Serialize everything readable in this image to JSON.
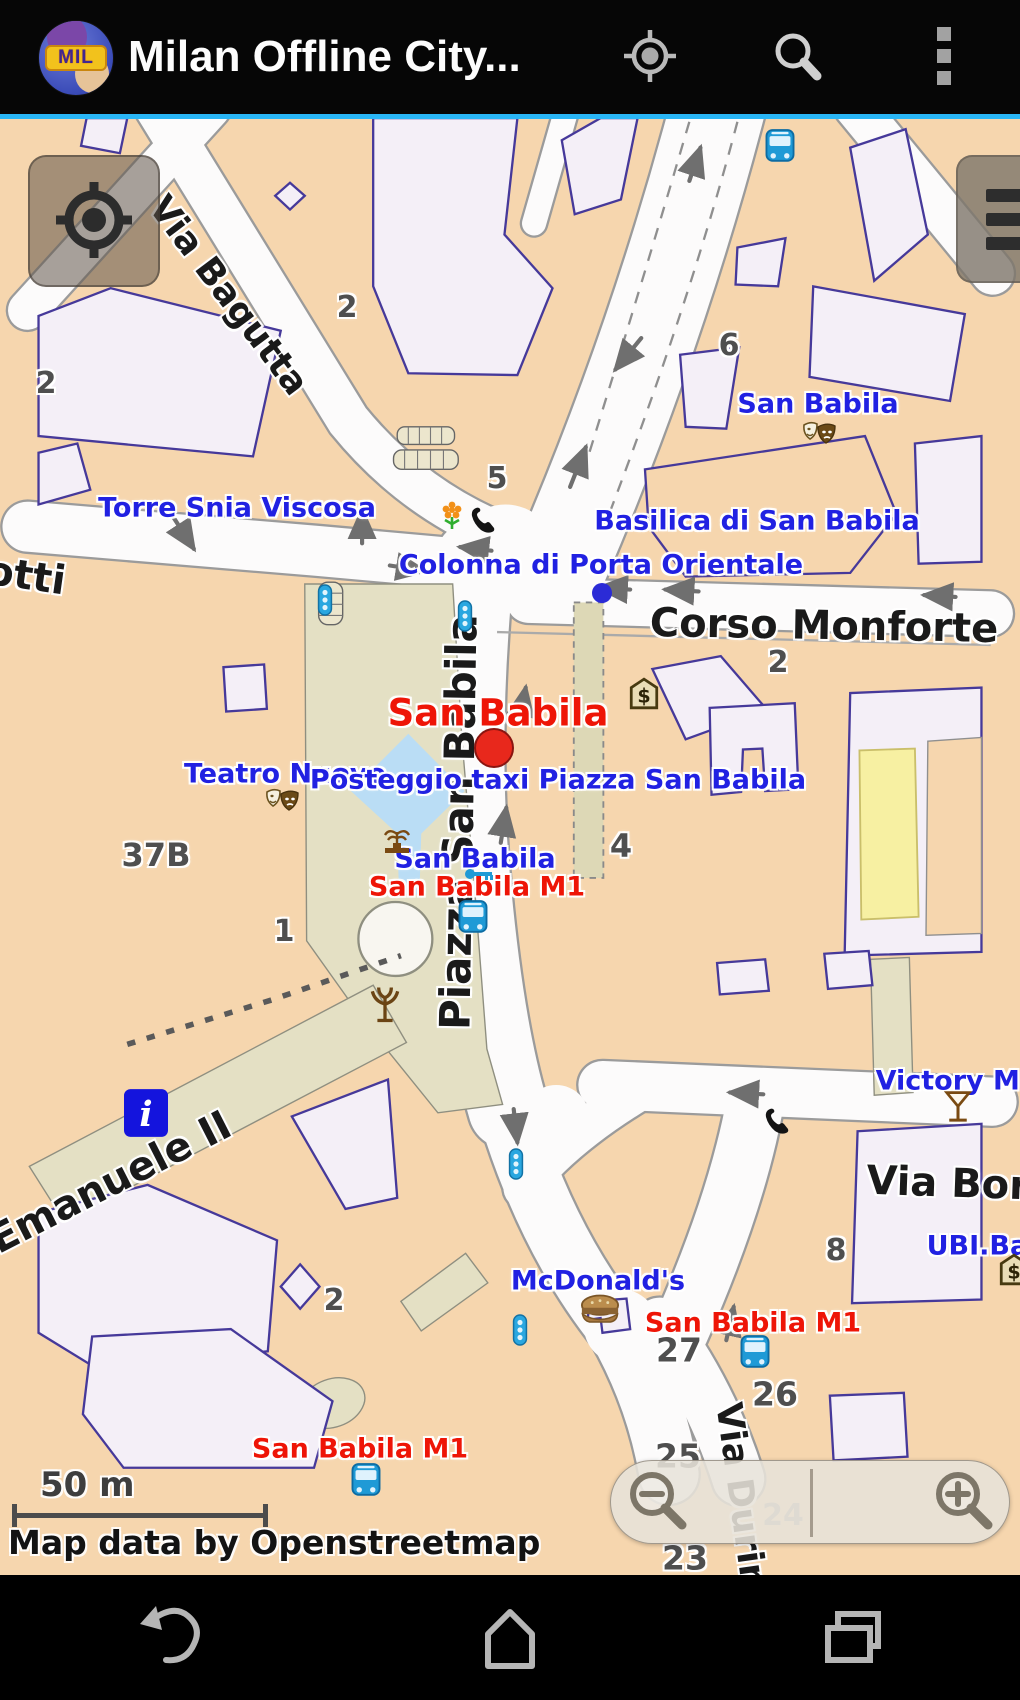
{
  "app_bar": {
    "logo_text": "MIL",
    "title": "Milan Offline City...",
    "actions": [
      {
        "name": "my-location"
      },
      {
        "name": "search"
      },
      {
        "name": "overflow-menu"
      }
    ]
  },
  "map": {
    "attribution": "Map data by Openstreetmap",
    "scale_label": "50 m",
    "controls": {
      "top_left": "my-location-button",
      "top_right": "layers-button",
      "zoom_out": "zoom-out-button",
      "zoom_in": "zoom-in-button"
    },
    "colors": {
      "accent_blue": "#29b6f6",
      "map_background": "#f6d6ae",
      "road": "#fcfbfb",
      "building_fill": "#f4eff7",
      "building_outline": "#46399a",
      "pedestrian_area": "#e4e0c4",
      "water": "#baddf5",
      "highlight_building": "#f7f0a2",
      "poi_label": "#2121e2",
      "transit_label": "#ee1507",
      "street_label": "#1a1a1a"
    },
    "labels": [
      {
        "text": "Via Bagutta",
        "type": "street",
        "x": 228,
        "y": 296,
        "rot": 53,
        "size": 36
      },
      {
        "text": "otti",
        "type": "street",
        "x": 26,
        "y": 576,
        "rot": 8,
        "size": 40
      },
      {
        "text": "Corso Monforte",
        "type": "street",
        "x": 824,
        "y": 626,
        "rot": 1,
        "size": 40
      },
      {
        "text": "Piazza San Babila",
        "type": "street",
        "x": 459,
        "y": 822,
        "rot": -89,
        "size": 42
      },
      {
        "text": "o Emanuele II",
        "type": "street",
        "x": 92,
        "y": 1192,
        "rot": -27,
        "size": 40
      },
      {
        "text": "Via Borg",
        "type": "street",
        "x": 962,
        "y": 1184,
        "rot": 2,
        "size": 40
      },
      {
        "text": "Via Durini",
        "type": "street",
        "x": 741,
        "y": 1502,
        "rot": 82,
        "size": 36
      },
      {
        "text": "San Babila",
        "type": "poi",
        "x": 818,
        "y": 404,
        "size": 27
      },
      {
        "text": "Torre Snia Viscosa",
        "type": "poi",
        "x": 237,
        "y": 508,
        "size": 27
      },
      {
        "text": "Basilica di San Babila",
        "type": "poi",
        "x": 757,
        "y": 521,
        "size": 27
      },
      {
        "text": "Colonna di Porta Orientale",
        "type": "poi",
        "x": 601,
        "y": 565,
        "size": 27
      },
      {
        "text": "Teatro Nuovo",
        "type": "poi",
        "x": 285,
        "y": 774,
        "size": 27
      },
      {
        "text": "Posteggio taxi Piazza San Babila",
        "type": "poi",
        "x": 558,
        "y": 780,
        "size": 27
      },
      {
        "text": "San Babila",
        "type": "poi",
        "x": 475,
        "y": 859,
        "size": 27
      },
      {
        "text": "Victory Milano",
        "type": "poi",
        "x": 985,
        "y": 1081,
        "size": 27
      },
      {
        "text": "UBI.Banc",
        "type": "poi",
        "x": 995,
        "y": 1246,
        "size": 27
      },
      {
        "text": "McDonald's",
        "type": "poi",
        "x": 598,
        "y": 1281,
        "size": 27
      },
      {
        "text": "San Babila",
        "type": "red-big",
        "x": 498,
        "y": 713,
        "size": 37
      },
      {
        "text": "San Babila M1",
        "type": "red",
        "x": 477,
        "y": 887,
        "size": 27
      },
      {
        "text": "San Babila M1",
        "type": "red",
        "x": 753,
        "y": 1323,
        "size": 27
      },
      {
        "text": "San Babila M1",
        "type": "red",
        "x": 360,
        "y": 1449,
        "size": 27
      },
      {
        "text": "2",
        "type": "num",
        "x": 347,
        "y": 308,
        "size": 30
      },
      {
        "text": "2",
        "type": "num",
        "x": 46,
        "y": 384,
        "size": 30
      },
      {
        "text": "6",
        "type": "num",
        "x": 729,
        "y": 346,
        "size": 30
      },
      {
        "text": "5",
        "type": "num",
        "x": 497,
        "y": 479,
        "size": 30
      },
      {
        "text": "2",
        "type": "num",
        "x": 778,
        "y": 663,
        "size": 30
      },
      {
        "text": "37B",
        "type": "num",
        "x": 156,
        "y": 855,
        "size": 32
      },
      {
        "text": "1",
        "type": "num",
        "x": 284,
        "y": 932,
        "size": 30
      },
      {
        "text": "4",
        "type": "num",
        "x": 621,
        "y": 846,
        "size": 32
      },
      {
        "text": "2",
        "type": "num",
        "x": 334,
        "y": 1301,
        "size": 30
      },
      {
        "text": "8",
        "type": "num",
        "x": 836,
        "y": 1251,
        "size": 30
      },
      {
        "text": "27",
        "type": "num",
        "x": 679,
        "y": 1350,
        "size": 33
      },
      {
        "text": "26",
        "type": "num",
        "x": 775,
        "y": 1394,
        "size": 33
      },
      {
        "text": "25",
        "type": "num",
        "x": 678,
        "y": 1456,
        "size": 33
      },
      {
        "text": "23",
        "type": "num",
        "x": 685,
        "y": 1558,
        "size": 33
      },
      {
        "text": "24",
        "type": "num-light",
        "x": 783,
        "y": 1516,
        "size": 30
      }
    ],
    "icons": [
      {
        "name": "theater-masks",
        "x": 820,
        "y": 434
      },
      {
        "name": "theater-masks",
        "x": 283,
        "y": 801
      },
      {
        "name": "fountain",
        "x": 397,
        "y": 841
      },
      {
        "name": "statue-tree",
        "x": 385,
        "y": 1004
      },
      {
        "name": "bank-dollar",
        "x": 644,
        "y": 694
      },
      {
        "name": "bank-dollar",
        "x": 1014,
        "y": 1270
      },
      {
        "name": "phone",
        "x": 483,
        "y": 521
      },
      {
        "name": "phone",
        "x": 777,
        "y": 1122
      },
      {
        "name": "flower",
        "x": 452,
        "y": 516
      },
      {
        "name": "bus",
        "x": 780,
        "y": 146
      },
      {
        "name": "bus",
        "x": 473,
        "y": 917
      },
      {
        "name": "bus",
        "x": 755,
        "y": 1352
      },
      {
        "name": "bus",
        "x": 366,
        "y": 1480
      },
      {
        "name": "traffic-signal",
        "x": 325,
        "y": 600
      },
      {
        "name": "traffic-signal",
        "x": 465,
        "y": 616
      },
      {
        "name": "traffic-signal",
        "x": 516,
        "y": 1164
      },
      {
        "name": "traffic-signal",
        "x": 520,
        "y": 1330
      },
      {
        "name": "info",
        "x": 146,
        "y": 1113
      },
      {
        "name": "burger",
        "x": 600,
        "y": 1311
      },
      {
        "name": "cocktail",
        "x": 958,
        "y": 1107
      },
      {
        "name": "key",
        "x": 479,
        "y": 874
      },
      {
        "name": "marker-red-dot",
        "x": 494,
        "y": 748
      },
      {
        "name": "marker-blue-dot",
        "x": 602,
        "y": 593
      }
    ]
  },
  "nav_bar": {
    "buttons": [
      {
        "name": "back"
      },
      {
        "name": "home"
      },
      {
        "name": "recents"
      }
    ]
  }
}
